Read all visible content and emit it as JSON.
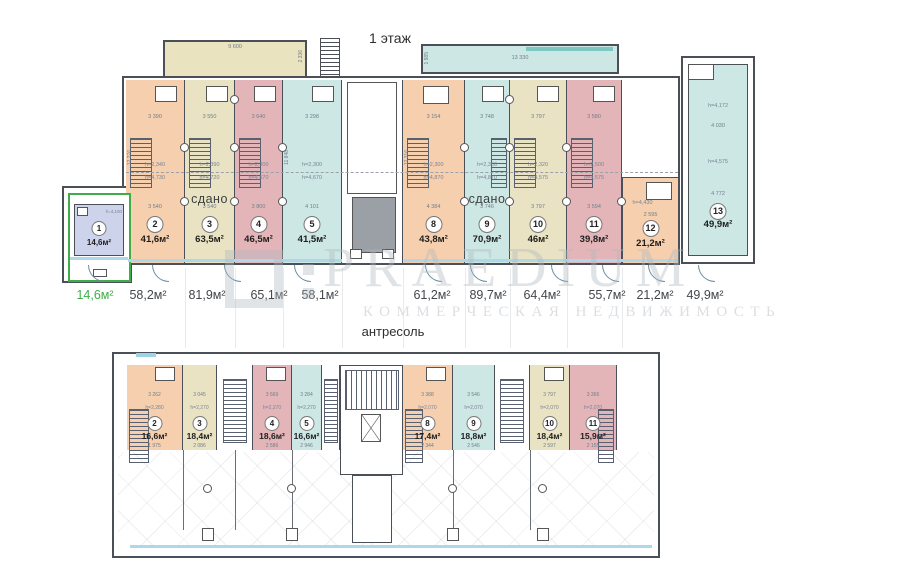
{
  "floor1": {
    "title": "1 этаж",
    "vestibule": {
      "dim": "9 600",
      "vdim": "2 336"
    },
    "corridor": {
      "dim": "13 330",
      "vdim": "1 985"
    },
    "units": [
      {
        "number": "1",
        "area": "14,6м²",
        "h_upper": "h=4,100"
      },
      {
        "number": "2",
        "area": "41,6м²",
        "dim_top": "3 390",
        "dim_mid": "3 540",
        "h_upper": "h=2,340",
        "h_lower": "h=4,730",
        "v_dim": "12 276"
      },
      {
        "number": "3",
        "area": "63,5м²",
        "status": "сдано",
        "dim_top": "3 550",
        "dim_mid": "3 540",
        "h_upper": "h=2,390",
        "h_lower": "h=4,720"
      },
      {
        "number": "4",
        "area": "46,5м²",
        "dim_top": "3 640",
        "dim_mid": "3 800",
        "h_upper": "h=2,300",
        "h_lower": "h=4,670"
      },
      {
        "number": "5",
        "area": "41,5м²",
        "dim_top": "3 298",
        "dim_mid": "4 101",
        "h_upper": "h=2,300",
        "h_lower": "h=4,670",
        "v_dim": "11 848"
      },
      {
        "number": "8",
        "area": "43,8м²",
        "dim_top": "3 154",
        "dim_mid": "4 384",
        "h_upper": "h=2,300",
        "h_lower": "h=4,870",
        "v_dim": "12 316"
      },
      {
        "number": "9",
        "area": "70,9м²",
        "status": "сдано",
        "dim_top": "3 748",
        "dim_mid": "3 746",
        "h_upper": "h=2,300",
        "h_lower": "h=4,870"
      },
      {
        "number": "10",
        "area": "46м²",
        "dim_top": "3 797",
        "dim_mid": "3 797",
        "h_upper": "h=2,320",
        "h_lower": "h=4,575"
      },
      {
        "number": "11",
        "area": "39,8м²",
        "dim_top": "3 580",
        "dim_mid": "3 594",
        "h_upper": "h=2,500",
        "h_lower": "h=4,575"
      },
      {
        "number": "12",
        "area": "21,2м²",
        "dim_top": "2 595",
        "h_upper": "h=4,430"
      },
      {
        "number": "13",
        "area": "49,9м²",
        "h_upper": "h=4,172",
        "dim_top": "4 030",
        "h_lower": "h=4,575",
        "dim_mid": "4 772"
      }
    ],
    "area_labels": [
      "14,6м²",
      "58,2м²",
      "81,9м²",
      "65,1м²",
      "58,1м²",
      "61,2м²",
      "89,7м²",
      "64,4м²",
      "55,7м²",
      "21,2м²",
      "49,9м²"
    ]
  },
  "mezzanine": {
    "title": "антресоль",
    "units": [
      {
        "number": "2",
        "area": "16,6м²",
        "dim_top": "3 262",
        "height": "h=2,280",
        "dim_bottom": "1 975"
      },
      {
        "number": "3",
        "area": "18,4м²",
        "dim_top": "3 045",
        "height": "h=2,270",
        "dim_bottom": "2 086"
      },
      {
        "number": "4",
        "area": "18,6м²",
        "dim_top": "3 569",
        "height": "h=2,270",
        "dim_bottom": "2 586"
      },
      {
        "number": "5",
        "area": "16,6м²",
        "dim_top": "3 284",
        "height": "h=2,270",
        "dim_bottom": "2 946"
      },
      {
        "number": "8",
        "area": "17,4м²",
        "dim_top": "3 388",
        "height": "h=2,070",
        "dim_bottom": "2 344"
      },
      {
        "number": "9",
        "area": "18,8м²",
        "dim_top": "3 546",
        "height": "h=2,070",
        "dim_bottom": "2 546"
      },
      {
        "number": "10",
        "area": "18,4м²",
        "dim_top": "3 797",
        "height": "h=2,070",
        "dim_bottom": "2 597"
      },
      {
        "number": "11",
        "area": "15,9м²",
        "dim_top": "3 366",
        "height": "h=2,070",
        "dim_bottom": "2 155"
      }
    ]
  },
  "watermark": {
    "brand": "PRAEDIUM",
    "subtitle": "КОММЕРЧЕСКАЯ НЕДВИЖИМОСТЬ"
  },
  "colors": {
    "orange": "#f6cfae",
    "beige": "#e9e3c3",
    "pink": "#e4b5b8",
    "teal": "#cde7e4",
    "lavender": "#ccd3eb",
    "vestibule_beige": "#eae3c0",
    "corridor_teal": "#cde7e4",
    "elevator_gray": "#9aa0a6",
    "window_blue": "#aed7ea",
    "highlight_green": "#3fae49",
    "wall": "#4a4f58"
  }
}
